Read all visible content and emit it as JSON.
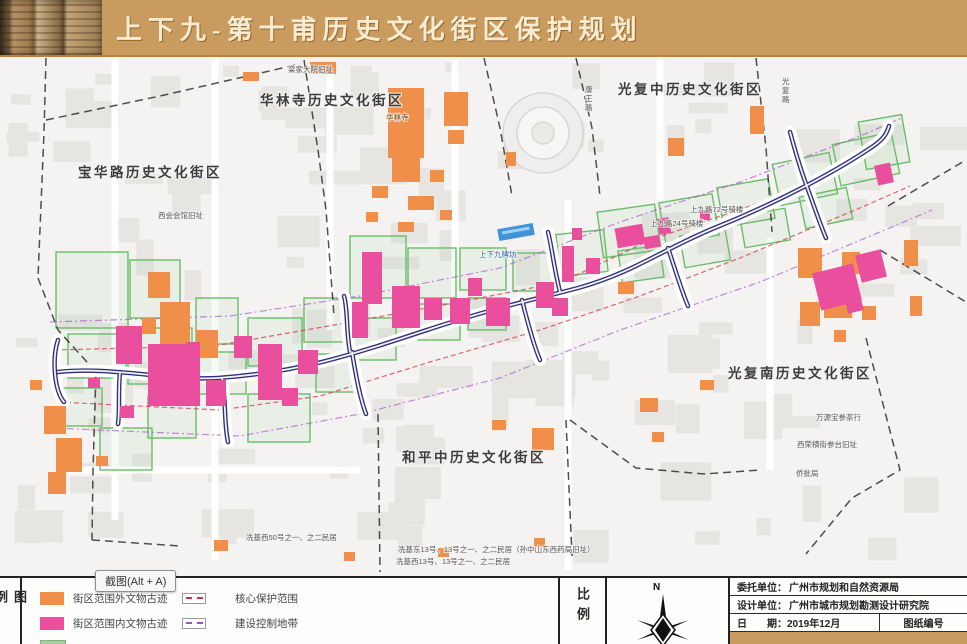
{
  "header": {
    "title": "上下九-第十甫历史文化街区保护规划"
  },
  "tooltip": {
    "text": "截图(Alt + A)"
  },
  "map": {
    "district_labels": [
      {
        "text": "宝华路历史文化街区",
        "x": 78,
        "y": 177
      },
      {
        "text": "华林寺历史文化街区",
        "x": 260,
        "y": 105
      },
      {
        "text": "光复中历史文化街区",
        "x": 618,
        "y": 94
      },
      {
        "text": "光复南历史文化街区",
        "x": 728,
        "y": 378
      },
      {
        "text": "和平中历史文化街区",
        "x": 402,
        "y": 462
      }
    ],
    "site_labels": [
      {
        "text": "华林寺",
        "x": 386,
        "y": 120,
        "color": "#7c4a12"
      },
      {
        "text": "梁家大院旧址",
        "x": 288,
        "y": 72
      },
      {
        "text": "西会会馆旧址",
        "x": 158,
        "y": 218
      },
      {
        "text": "上九路72号骑楼",
        "x": 690,
        "y": 212
      },
      {
        "text": "上九路24号骑楼",
        "x": 650,
        "y": 226
      },
      {
        "text": "上下九牌坊",
        "x": 479,
        "y": 257,
        "color": "#2c6db5"
      },
      {
        "text": "冼基西50号之一、之二民居",
        "x": 246,
        "y": 540
      },
      {
        "text": "冼基东13号、13号之一、之二民居（孙中山东西药局旧址）",
        "x": 398,
        "y": 552
      },
      {
        "text": "冼基西13号、13号之一、之二民居",
        "x": 396,
        "y": 564
      },
      {
        "text": "万源宝参茶行",
        "x": 816,
        "y": 420
      },
      {
        "text": "西荣横街参台旧址",
        "x": 797,
        "y": 447
      },
      {
        "text": "侨批局",
        "x": 796,
        "y": 476
      },
      {
        "text": "康王路",
        "x": 585,
        "y": 92,
        "vertical": true
      },
      {
        "text": "光复路",
        "x": 782,
        "y": 84,
        "vertical": true
      }
    ]
  },
  "legend": {
    "panel_label": "图例",
    "fill_items": [
      {
        "label": "街区范围外文物古迹",
        "color": "#ef8f4a"
      },
      {
        "label": "街区范围内文物古迹",
        "color": "#ea4f9d"
      }
    ],
    "line_items": [
      {
        "label": "核心保护范围",
        "color": "#d23548"
      },
      {
        "label": "建设控制地带",
        "color": "#a44fd0"
      }
    ]
  },
  "scale": {
    "panel_label": "比例"
  },
  "compass": {
    "north_label": "N"
  },
  "info_table": {
    "rows": [
      {
        "label": "委托单位：",
        "value": "广州市规划和自然资源局"
      },
      {
        "label": "设计单位：",
        "value": "广州市城市规划勘测设计研究院"
      }
    ],
    "date_label": "日　　期：",
    "date_value": "2019年12月",
    "sheet_no_label": "图纸编号"
  },
  "colors": {
    "gold": "#ca9b5e",
    "map_bg": "#f4f3f1",
    "relic_outside": "#ef8f4a",
    "relic_inside": "#ea4f9d",
    "core_line": "#d23548",
    "control_line": "#a44fd0",
    "street_navy": "#2f2f7d",
    "green": "#69bd69",
    "archway_blue": "#3f93d8",
    "partial_swatch": "#a8cfa0"
  }
}
